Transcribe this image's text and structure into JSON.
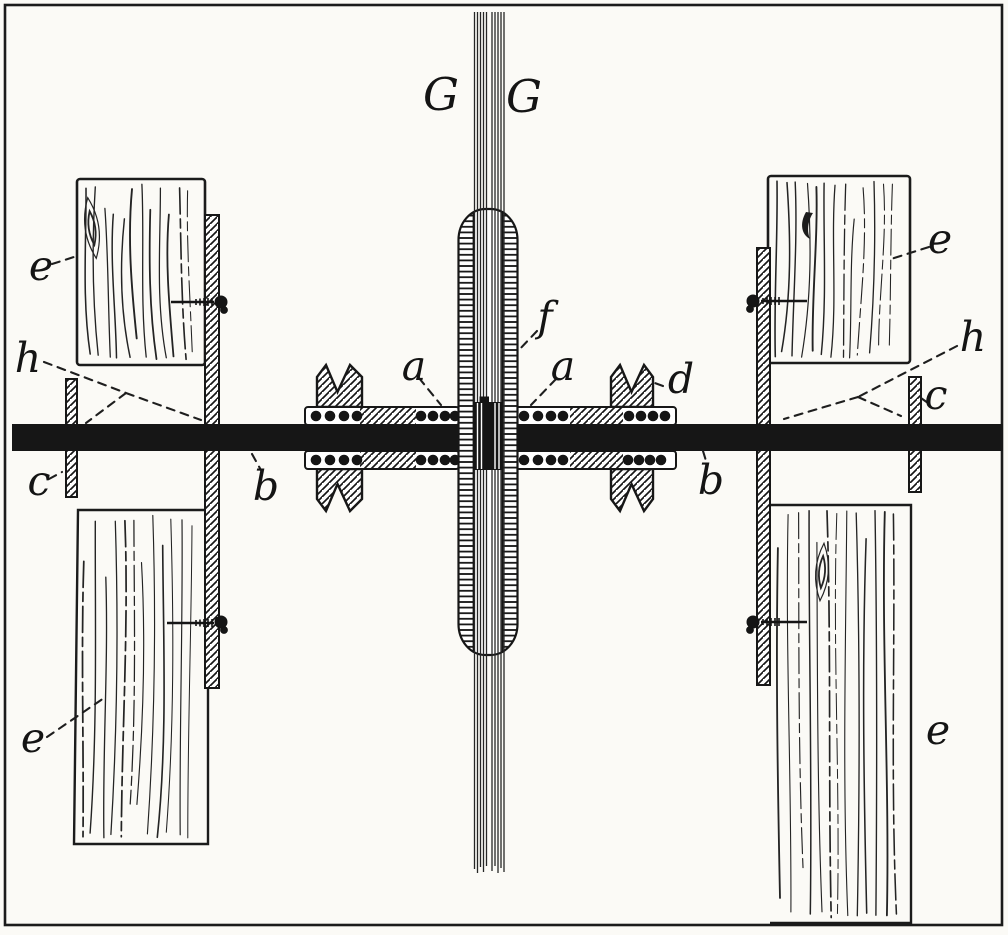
{
  "figure": {
    "kind": "technical-engraving-cross-section",
    "paper_color": "#fbfaf6",
    "ink_color": "#1b1b1b",
    "caption": ""
  },
  "labels": {
    "g_left": "G",
    "g_right": "G",
    "f": "f",
    "a_left": "a",
    "a_right": "a",
    "d": "d",
    "b_left": "b",
    "b_right": "b",
    "c_left": "c",
    "c_right": "c",
    "h_left": "h",
    "h_right": "h",
    "e_top_left": "e",
    "e_top_right": "e",
    "e_bottom_left": "e",
    "e_bottom_right": "e"
  }
}
